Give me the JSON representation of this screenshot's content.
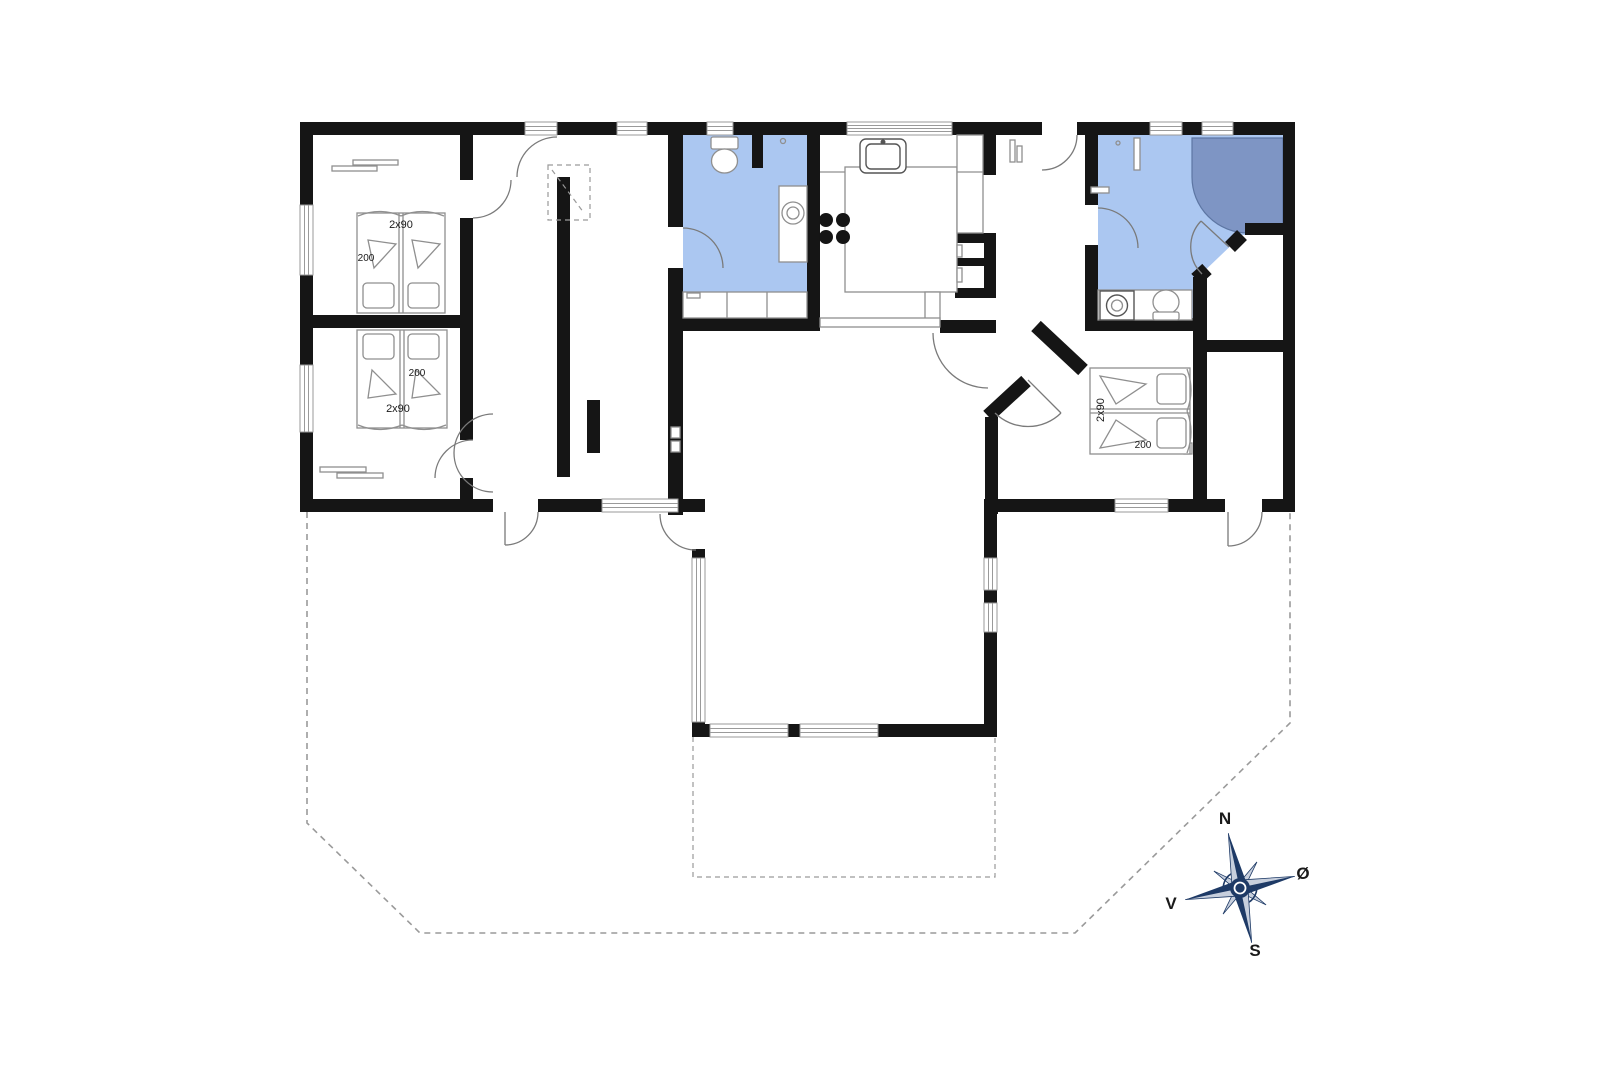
{
  "colors": {
    "wall": "#151515",
    "bathroom_fill": "#abc7f1",
    "shower_fill": "#7e95c4",
    "fixture_line": "#8f8f8f",
    "terrace_dash": "#9a9a9a",
    "compass_navy": "#1e3a66"
  },
  "beds": {
    "left_top": {
      "size": "2x90",
      "length": "200"
    },
    "left_bottom": {
      "size": "2x90",
      "length": "200"
    },
    "right": {
      "size": "2x90",
      "length": "200"
    }
  },
  "compass": {
    "north": "N",
    "east": "Ø",
    "south": "S",
    "west": "V"
  }
}
